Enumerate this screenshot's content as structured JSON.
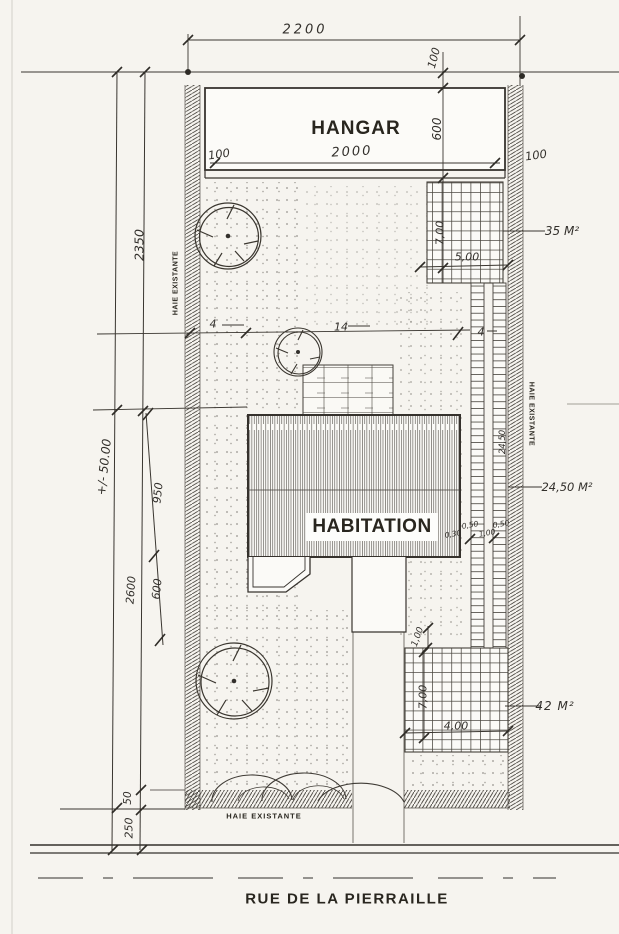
{
  "colors": {
    "ink": "#33302c",
    "paper": "#f6f4ef"
  },
  "buildings": {
    "hangar": "HANGAR",
    "habitation": "HABITATION"
  },
  "street_name": "RUE DE LA PIERRAILLE",
  "hedges": {
    "left": "HAIE EXISTANTE",
    "right": "HAIE EXISTANTE",
    "bottom": "HAIE EXISTANTE"
  },
  "areas": {
    "upper_terrace": "35 M²",
    "paths": "24,50 M²",
    "lower_terrace": "42 M²"
  },
  "dims": {
    "lot_width": "2200",
    "hangar_width": "2000",
    "hangar_depth": "600",
    "hangar_setback": "100",
    "hangar_wall_left": "100",
    "hangar_wall_right": "100",
    "left_upper": "2350",
    "lot_depth": "+/- 50.00",
    "house_depth": "950",
    "house_to_terrace": "600",
    "rear_depth": "2600",
    "cross_left": "4",
    "cross_center": "14",
    "cross_right": "4",
    "terrace_up_h": "7,00",
    "terrace_up_w": "5,00",
    "path_gap_house": "0,30",
    "path_width_1": "0,50",
    "path_gap": "1,00",
    "path_width_2": "0,50",
    "path_length": "24,50",
    "step_gap": "1,00",
    "terrace_low_h": "7,00",
    "terrace_low_w": "4,00",
    "hedge_depth": "50",
    "front_setback": "250"
  }
}
